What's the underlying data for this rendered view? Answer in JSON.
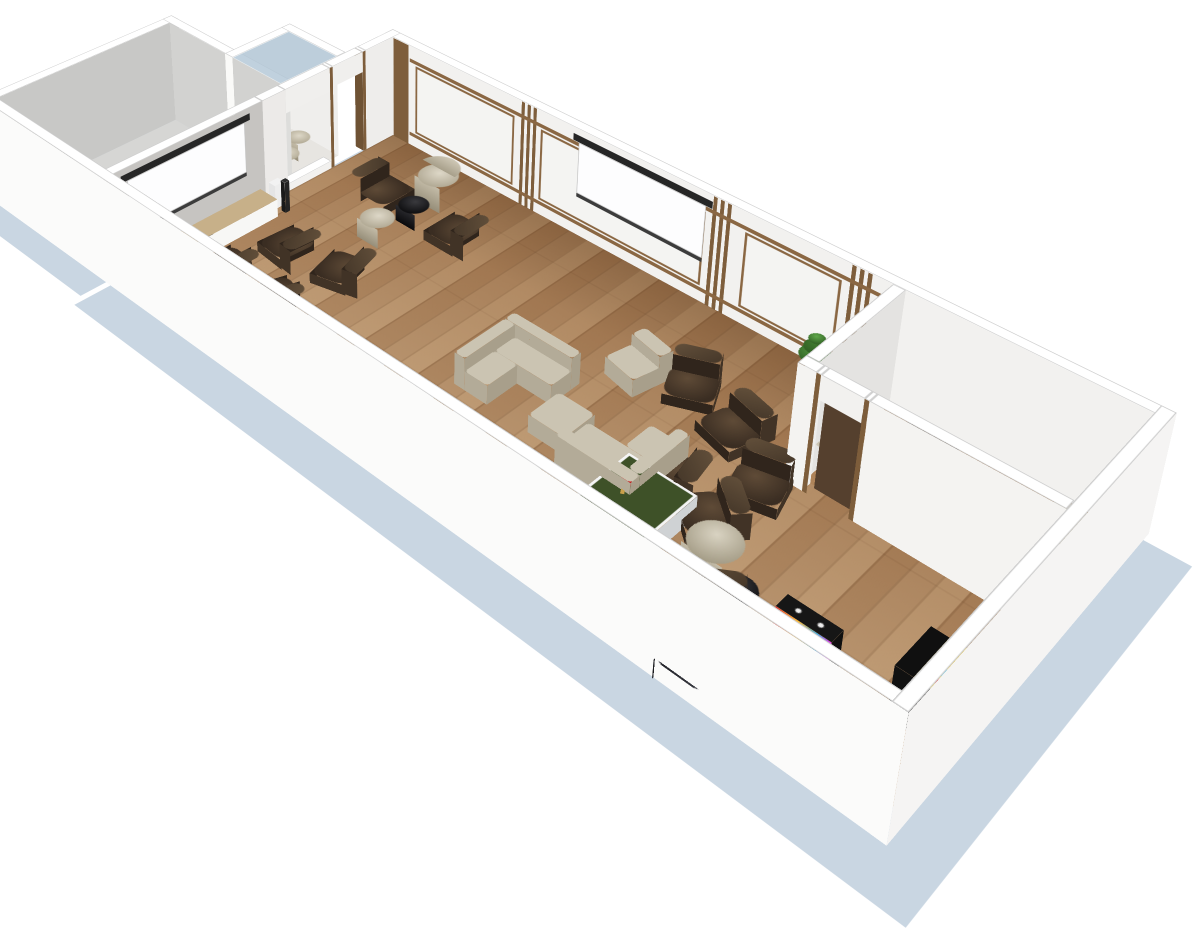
{
  "scene": {
    "canvas": {
      "w": 1200,
      "h": 942,
      "bg": "#ffffff"
    },
    "camera": {
      "perspective": 1800,
      "origin_x": 400,
      "origin_y": -100,
      "tx": 393,
      "ty": 135,
      "rot_x": 65,
      "rot_z": 45,
      "scale": 0.8,
      "wall_h": 140
    },
    "palette": {
      "ground_shadow": "#c9d6e2",
      "wall_top": "#ffffff",
      "wall_white": "#f2f1ef",
      "wall_gray": "#c6c4c1",
      "wood_trim": "#7e5e3c",
      "rail": "#8a6743",
      "floor_wood": "#a8805a",
      "annex_floor": "#d6d6d4",
      "bean_brown": "#4a3a2b",
      "bean_black": "#1b1c20",
      "quilt_beige": "#cbc4b2",
      "lounger_white": "#fcfcfc",
      "pingpong_green": "#3e5128",
      "paddle_red": "#c22222",
      "cube_red": "#9c2020",
      "arcade_yellow": "#f2c71e",
      "screen_white": "#fdfdfe",
      "screen_bar": "#262626",
      "plant_green": "#4c8a3c",
      "glass": "rgba(176,198,214,0.8)"
    },
    "shadows": [
      {
        "n": "ground-shadow-main",
        "x": -6,
        "y": -6,
        "w": 1014,
        "d": 486
      },
      {
        "n": "ground-shadow-annex",
        "x": -258,
        "y": 160,
        "w": 244,
        "d": 306
      }
    ],
    "floors": [
      {
        "n": "hall-floor",
        "x": 0,
        "y": 0,
        "w": 950,
        "d": 420,
        "cls": "wood"
      },
      {
        "n": "small-room-floor-tint",
        "x": 704,
        "y": 0,
        "w": 246,
        "d": 150,
        "bg": "rgba(160,95,35,0.20)"
      },
      {
        "n": "annex-floor",
        "x": -220,
        "y": 170,
        "w": 206,
        "d": 250,
        "bg": "#d6d6d4"
      },
      {
        "n": "vestibule-floor",
        "x": -100,
        "y": 80,
        "w": 86,
        "d": 90,
        "bg": "#e7e5e1"
      }
    ],
    "walls": [
      {
        "n": "wall-north-paneled",
        "x": -14,
        "y": -14,
        "w": 978,
        "d": 14,
        "front": "#f2f1ef",
        "side": "#ebebe9"
      },
      {
        "n": "wall-west-seg-corner",
        "x": -14,
        "y": -14,
        "w": 14,
        "d": 60,
        "side": "#eeedeb",
        "front": "#f6f5f3"
      },
      {
        "n": "door-jamb-1",
        "x": -14,
        "y": 46,
        "w": 14,
        "d": 5,
        "side": "#7d5d3b",
        "front": "#6e5234"
      },
      {
        "n": "door-header",
        "x": -14,
        "y": 51,
        "w": 14,
        "d": 49,
        "z0": 112,
        "h": 28,
        "side": "#f0efed"
      },
      {
        "n": "door-jamb-2",
        "x": -14,
        "y": 100,
        "w": 14,
        "d": 5,
        "side": "#7d5d3b"
      },
      {
        "n": "window-sill",
        "x": -14,
        "y": 105,
        "w": 14,
        "d": 70,
        "h": 10,
        "side": "#f2f1ef"
      },
      {
        "n": "window-header",
        "x": -14,
        "y": 105,
        "w": 14,
        "d": 70,
        "z0": 108,
        "h": 32,
        "side": "#f0efed"
      },
      {
        "n": "wall-west-seg-mid",
        "x": -14,
        "y": 175,
        "w": 14,
        "d": 35,
        "side": "#eceae8"
      },
      {
        "n": "wall-west-gray-media",
        "x": -14,
        "y": 210,
        "w": 14,
        "d": 224,
        "side": "#c6c4c1"
      },
      {
        "n": "wall-south-outer",
        "x": -234,
        "y": 420,
        "w": 1198,
        "d": 14,
        "front": "#fbfbfa",
        "side": "#f1f1f0"
      },
      {
        "n": "wall-east-outer",
        "x": 950,
        "y": -14,
        "w": 14,
        "d": 448,
        "side": "#f5f4f3",
        "front": "#fbfbfa"
      },
      {
        "n": "small-room-wall-nw",
        "x": 690,
        "y": 0,
        "w": 14,
        "d": 150,
        "side": "#e4e3e1",
        "front": "#f1f0ee"
      },
      {
        "n": "small-room-wall-sw-a",
        "x": 690,
        "y": 150,
        "w": 20,
        "d": 14,
        "front": "#f4f3f1",
        "side": "#eeedeb"
      },
      {
        "n": "small-room-door-jamb-1",
        "x": 710,
        "y": 150,
        "w": 5,
        "d": 14,
        "front": "#7d5d3b"
      },
      {
        "n": "small-room-door-header",
        "x": 715,
        "y": 150,
        "w": 45,
        "d": 14,
        "z0": 112,
        "h": 28,
        "front": "#f2f1ef"
      },
      {
        "n": "small-room-door-jamb-2",
        "x": 760,
        "y": 150,
        "w": 5,
        "d": 14,
        "front": "#7d5d3b"
      },
      {
        "n": "small-room-wall-sw-b",
        "x": 765,
        "y": 150,
        "w": 185,
        "d": 14,
        "front": "#f4f3f1"
      },
      {
        "n": "annex-wall-west",
        "x": -234,
        "y": 156,
        "w": 14,
        "d": 264,
        "side": "#c8c8c6",
        "front": "#f0f0ee"
      },
      {
        "n": "annex-wall-north",
        "x": -234,
        "y": 156,
        "w": 220,
        "d": 14,
        "front": "#d2d2d0",
        "side": "#dddddb"
      },
      {
        "n": "vestibule-wall-west",
        "x": -114,
        "y": 66,
        "w": 14,
        "d": 104,
        "side": "#f0efed",
        "front": "#fafaf8"
      },
      {
        "n": "vestibule-wall-north",
        "x": -114,
        "y": 66,
        "w": 100,
        "d": 14,
        "front": "#efeeec"
      }
    ],
    "wall_decor_x": [
      {
        "n": "panel-corner-wood-band",
        "x": 2,
        "y": 0.8,
        "len": 26,
        "z0": 0,
        "h": 140,
        "bg": "#7e5e3c"
      },
      {
        "n": "panel-slats-1a",
        "x": 210,
        "y": 0.8,
        "len": 5,
        "z0": 0,
        "h": 140,
        "bg": "#7e5e3c"
      },
      {
        "n": "panel-slats-1b",
        "x": 219,
        "y": 0.8,
        "len": 5,
        "z0": 0,
        "h": 140,
        "bg": "#7e5e3c"
      },
      {
        "n": "panel-slats-1c",
        "x": 228,
        "y": 0.8,
        "len": 5,
        "z0": 0,
        "h": 140,
        "bg": "#7e5e3c"
      },
      {
        "n": "panel-slats-2a",
        "x": 478,
        "y": 0.8,
        "len": 5,
        "z0": 0,
        "h": 140,
        "bg": "#7e5e3c"
      },
      {
        "n": "panel-slats-2b",
        "x": 487,
        "y": 0.8,
        "len": 5,
        "z0": 0,
        "h": 140,
        "bg": "#7e5e3c"
      },
      {
        "n": "panel-slats-2c",
        "x": 496,
        "y": 0.8,
        "len": 5,
        "z0": 0,
        "h": 140,
        "bg": "#7e5e3c"
      },
      {
        "n": "panel-slats-3a",
        "x": 645,
        "y": 0.8,
        "len": 5,
        "z0": 0,
        "h": 140,
        "bg": "#7e5e3c"
      },
      {
        "n": "panel-slats-3b",
        "x": 654,
        "y": 0.8,
        "len": 5,
        "z0": 0,
        "h": 140,
        "bg": "#7e5e3c"
      },
      {
        "n": "panel-slats-3c",
        "x": 663,
        "y": 0.8,
        "len": 5,
        "z0": 0,
        "h": 140,
        "bg": "#7e5e3c"
      },
      {
        "n": "panel-rail-low",
        "x": 30,
        "y": 0.9,
        "len": 658,
        "z0": 14,
        "h": 5,
        "bg": "#8a6743"
      },
      {
        "n": "panel-rail-high",
        "x": 30,
        "y": 0.9,
        "len": 658,
        "z0": 118,
        "h": 5,
        "bg": "#8a6743"
      },
      {
        "n": "wall-panel-1",
        "x": 40,
        "y": 1,
        "len": 160,
        "z0": 21,
        "h": 95,
        "bg": "#f4f4f2",
        "bd": "3px solid #8a6743"
      },
      {
        "n": "wall-panel-2",
        "x": 240,
        "y": 1,
        "len": 230,
        "z0": 21,
        "h": 95,
        "bg": "#f4f4f2",
        "bd": "3px solid #8a6743"
      },
      {
        "n": "wall-panel-3",
        "x": 520,
        "y": 1,
        "len": 116,
        "z0": 21,
        "h": 95,
        "bg": "#f4f4f2",
        "bd": "3px solid #8a6743"
      },
      {
        "n": "projector-screen-north-bar",
        "x": 288,
        "y": 1.6,
        "len": 190,
        "z0": 124,
        "h": 9,
        "bg": "#262626"
      },
      {
        "n": "projector-screen-north-canvas",
        "x": 296,
        "y": 1.6,
        "len": 174,
        "z0": 57,
        "h": 67,
        "bg": "#fdfdfe",
        "bd": "1px solid #c2c2c2"
      },
      {
        "n": "projector-screen-north-rod",
        "x": 296,
        "y": 1.6,
        "len": 174,
        "z0": 52,
        "h": 5,
        "bg": "#3c3c3c"
      },
      {
        "n": "small-room-door-leaf",
        "x": 716,
        "y": 153,
        "len": 42,
        "z0": 0,
        "h": 112,
        "bg": "#55402e"
      }
    ],
    "wall_decor_y": [
      {
        "n": "projector-screen-west-bar",
        "x": 0.8,
        "y": 230,
        "len": 182,
        "z0": 124,
        "h": 9,
        "bg": "#262626"
      },
      {
        "n": "projector-screen-west-canvas",
        "x": 0.8,
        "y": 238,
        "len": 166,
        "z0": 57,
        "h": 67,
        "bg": "#fdfdfe",
        "bd": "1px solid #c2c2c2"
      },
      {
        "n": "projector-screen-west-rod",
        "x": 0.8,
        "y": 238,
        "len": 166,
        "z0": 52,
        "h": 5,
        "bg": "#3c3c3c"
      }
    ],
    "glass": {
      "n": "vestibule-glass-roof",
      "x": -100,
      "y": 80,
      "w": 86,
      "d": 90,
      "z": 140
    },
    "boxes": [
      {
        "n": "media-sideboard",
        "x": 0,
        "y": 218,
        "w": 30,
        "d": 202,
        "h": 24,
        "top": "#c7b089",
        "front": "#f4f4f2",
        "side": "#f7f7f5",
        "cls": "wtop"
      },
      {
        "n": "sideboard-electronics-1",
        "x": 6,
        "y": 298,
        "w": 12,
        "d": 18,
        "h": 6,
        "top": "#1e1e1e",
        "front": "#141414",
        "side": "#181818"
      },
      {
        "n": "sideboard-electronics-2",
        "x": 8,
        "y": 344,
        "w": 10,
        "d": 14,
        "h": 5,
        "top": "#2b2b2b",
        "front": "#1c1c1c",
        "side": "#222222"
      },
      {
        "n": "sideboard-tray",
        "x": 4,
        "y": 252,
        "w": 8,
        "d": 42,
        "h": 4,
        "top": "#fafafa",
        "front": "#e8e8e8",
        "side": "#ededed"
      },
      {
        "n": "game-console-white",
        "x": 6,
        "y": 196,
        "w": 11,
        "d": 14,
        "h": 32,
        "top": "#f2f2f2",
        "front": "#e5e5e5",
        "side": "#ededed"
      },
      {
        "n": "speaker-dark",
        "x": 24,
        "y": 200,
        "w": 7,
        "d": 7,
        "h": 42,
        "top": "#2e2e2e",
        "front": "#1a1a1a",
        "side": "#242424"
      },
      {
        "n": "ottoman-quilted",
        "x": 475,
        "y": 240,
        "w": 46,
        "d": 46,
        "h": 22,
        "top": "#cbc4b2",
        "front": "#b3ab98",
        "side": "#a89f8b",
        "r": 6,
        "cls": "q",
        "clsf": "qf"
      },
      {
        "n": "red-cube-pouf",
        "x": 778,
        "y": 392,
        "w": 30,
        "d": 30,
        "h": 26,
        "top": "#9c2020",
        "front": "#7c1717",
        "side": "#8a1b1b",
        "r": 4
      }
    ],
    "beans": [
      {
        "n": "beanbag-screen-1",
        "x": 90,
        "y": 255,
        "rot": 95,
        "kind": "b"
      },
      {
        "n": "beanbag-screen-2",
        "x": 165,
        "y": 245,
        "rot": 75,
        "kind": "b"
      },
      {
        "n": "beanbag-screen-3",
        "x": 70,
        "y": 330,
        "rot": 92,
        "kind": "b"
      },
      {
        "n": "beanbag-screen-4",
        "x": 148,
        "y": 328,
        "rot": 108,
        "kind": "b"
      },
      {
        "n": "beanbag-screen-5",
        "x": 112,
        "y": 396,
        "rot": 85,
        "kind": "b"
      },
      {
        "n": "beanbag-circle-left",
        "x": 92,
        "y": 105,
        "rot": -90,
        "kind": "b"
      },
      {
        "n": "beanbag-circle-right",
        "x": 205,
        "y": 105,
        "rot": 90,
        "kind": "b"
      },
      {
        "n": "beanbag-east-1",
        "x": 555,
        "y": 128,
        "rot": -25,
        "kind": "b"
      },
      {
        "n": "beanbag-east-2",
        "x": 620,
        "y": 152,
        "rot": 15,
        "kind": "b"
      },
      {
        "n": "beanbag-east-3",
        "x": 683,
        "y": 196,
        "rot": -15,
        "kind": "b"
      },
      {
        "n": "beanbag-east-4",
        "x": 613,
        "y": 242,
        "rot": 80,
        "kind": "b"
      },
      {
        "n": "beanbag-east-5",
        "x": 670,
        "y": 262,
        "rot": 40,
        "kind": "b"
      },
      {
        "n": "beanbag-east-6",
        "x": 750,
        "y": 355,
        "rot": -35,
        "kind": "b"
      },
      {
        "n": "beanbag-room-1",
        "x": 762,
        "y": 40,
        "rot": 185,
        "kind": "b"
      },
      {
        "n": "beanbag-room-2",
        "x": 820,
        "y": 64,
        "rot": 168,
        "kind": "b"
      },
      {
        "n": "beanbag-room-3",
        "x": 780,
        "y": 110,
        "rot": 200,
        "kind": "b"
      },
      {
        "n": "black-lounger-1",
        "x": 640,
        "y": 388,
        "rot": 183,
        "kind": "d"
      },
      {
        "n": "black-lounger-2",
        "x": 685,
        "y": 392,
        "rot": 178,
        "kind": "d"
      },
      {
        "n": "black-lounger-3",
        "x": 728,
        "y": 396,
        "rot": 185,
        "kind": "d"
      },
      {
        "n": "black-lounger-4",
        "x": 768,
        "y": 400,
        "rot": 180,
        "kind": "d"
      }
    ],
    "cyls": [
      {
        "n": "barrel-chair",
        "x": 138,
        "y": 62,
        "r": 24,
        "h": 34,
        "kind": "barrel",
        "back": 1
      },
      {
        "n": "black-pouf-circle",
        "x": 147,
        "y": 112,
        "r": 18,
        "h": 22,
        "kind": "black"
      },
      {
        "n": "barrel-pouf",
        "x": 140,
        "y": 164,
        "r": 20,
        "h": 26,
        "kind": "barrel"
      },
      {
        "n": "beige-round-beanbag",
        "x": 707,
        "y": 300,
        "r": 26,
        "h": 30,
        "kind": "beige"
      },
      {
        "n": "black-pouf-east",
        "x": 749,
        "y": 326,
        "r": 19,
        "h": 22,
        "kind": "black"
      },
      {
        "n": "vestibule-pouf-1",
        "x": -52,
        "y": 112,
        "r": 15,
        "h": 24,
        "kind": "barrel"
      },
      {
        "n": "vestibule-pouf-2",
        "x": -34,
        "y": 146,
        "r": 15,
        "h": 24,
        "kind": "barrel"
      },
      {
        "n": "vestibule-pouf-3",
        "x": -82,
        "y": 126,
        "r": 13,
        "h": 22,
        "kind": "barrel"
      },
      {
        "n": "vestibule-pouf-black",
        "x": -64,
        "y": 148,
        "r": 13,
        "h": 22,
        "kind": "black"
      }
    ],
    "loungers": {
      "xs": [
        210,
        280,
        350,
        420,
        490
      ],
      "y": 325,
      "w": 38,
      "d": 92
    },
    "sofas": [
      {
        "n": "sofa-L-west",
        "x": 375,
        "y": 195,
        "o": "NW"
      },
      {
        "n": "sofa-L-east",
        "x": 525,
        "y": 215,
        "o": "SE"
      }
    ],
    "seatruns": [
      {
        "n": "room-sofa-east-run",
        "x": 893,
        "y": 28,
        "w": 46,
        "d": 112,
        "back": "E"
      },
      {
        "n": "room-sofa-south-run",
        "x": 808,
        "y": 96,
        "w": 85,
        "d": 44,
        "back": "S"
      }
    ],
    "modules": [
      {
        "n": "armchair-module-north",
        "x": 498,
        "y": 152,
        "rot": 12
      },
      {
        "n": "room-module-near-door",
        "x": 726,
        "y": 106,
        "rot": 185
      }
    ],
    "pingpong": {
      "n": "ping-pong-table",
      "x": 580,
      "y": 262,
      "w": 80,
      "d": 140,
      "h": 26,
      "paddles": [
        {
          "x": 22,
          "y": 34,
          "rot": -30
        },
        {
          "x": 44,
          "y": 104,
          "rot": 140
        }
      ]
    },
    "pinball": {
      "n": "pinball-machine",
      "x": 800,
      "y": 330,
      "w": 54,
      "d": 103
    },
    "arcade": {
      "n": "pacman-arcade-cabinet",
      "x": 902,
      "y": 276,
      "w": 46,
      "d": 56,
      "h": 58
    },
    "plant": {
      "n": "potted-plant",
      "x": 625,
      "y": 16
    }
  }
}
